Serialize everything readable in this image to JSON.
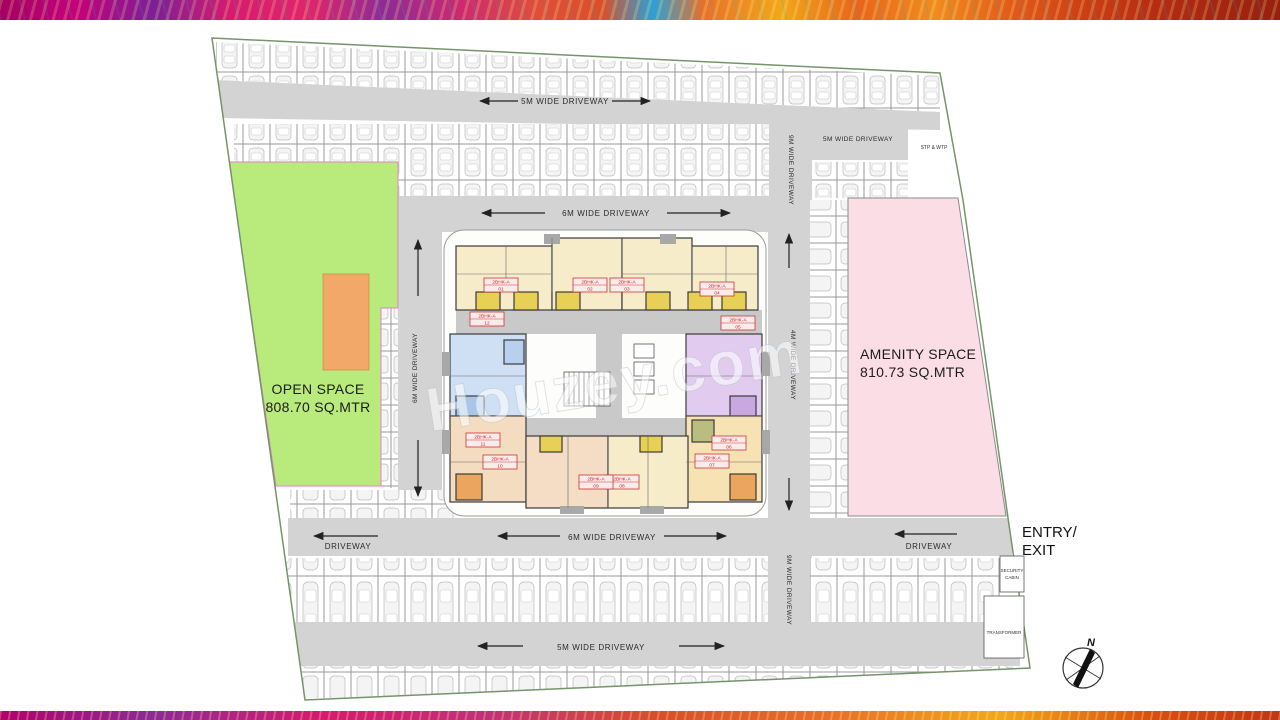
{
  "plan": {
    "watermark": "Houzey.com",
    "open_space": {
      "title": "OPEN SPACE",
      "area": "808.70 SQ.MTR",
      "fill": "#b9ea7c",
      "border": "#e87fc8",
      "accent_fill": "#f1a868"
    },
    "amenity_space": {
      "title": "AMENITY SPACE",
      "area": "810.73 SQ.MTR",
      "fill": "#fbdde6",
      "border": "#8a8a8a"
    },
    "entry_exit": {
      "line1": "ENTRY/",
      "line2": "EXIT"
    },
    "stp_wtp": "STP & WTP",
    "security_cabin": {
      "line1": "SECURITY",
      "line2": "CABIN"
    },
    "transformer": "TRANSFORMER",
    "compass_north": "N",
    "driveways": {
      "top": "5M WIDE DRIVEWAY",
      "top_right": "5M WIDE DRIVEWAY",
      "upper_inner": "6M WIDE DRIVEWAY",
      "left_vertical": "6M WIDE DRIVEWAY",
      "right_vertical_upper": "9M WIDE DRIVEWAY",
      "right_vertical_mid": "4M WIDE DRIVEWAY",
      "right_vertical_lower": "9M WIDE DRIVEWAY",
      "lower_inner": "6M WIDE DRIVEWAY",
      "lower_left": "DRIVEWAY",
      "lower_right": "DRIVEWAY",
      "bottom": "5M WIDE DRIVEWAY"
    },
    "units": [
      {
        "type": "2BHK-A",
        "no": "01"
      },
      {
        "type": "2BHK-A",
        "no": "02"
      },
      {
        "type": "2BHK-A",
        "no": "03"
      },
      {
        "type": "2BHK-A",
        "no": "04"
      },
      {
        "type": "2BHK-A",
        "no": "05"
      },
      {
        "type": "2BHK-A",
        "no": "06"
      },
      {
        "type": "2BHK-A",
        "no": "07"
      },
      {
        "type": "2BHK-A",
        "no": "08"
      },
      {
        "type": "2BHK-A",
        "no": "09"
      },
      {
        "type": "2BHK-A",
        "no": "10"
      },
      {
        "type": "2BHK-A",
        "no": "11"
      },
      {
        "type": "2BHK-A",
        "no": "12"
      }
    ]
  }
}
